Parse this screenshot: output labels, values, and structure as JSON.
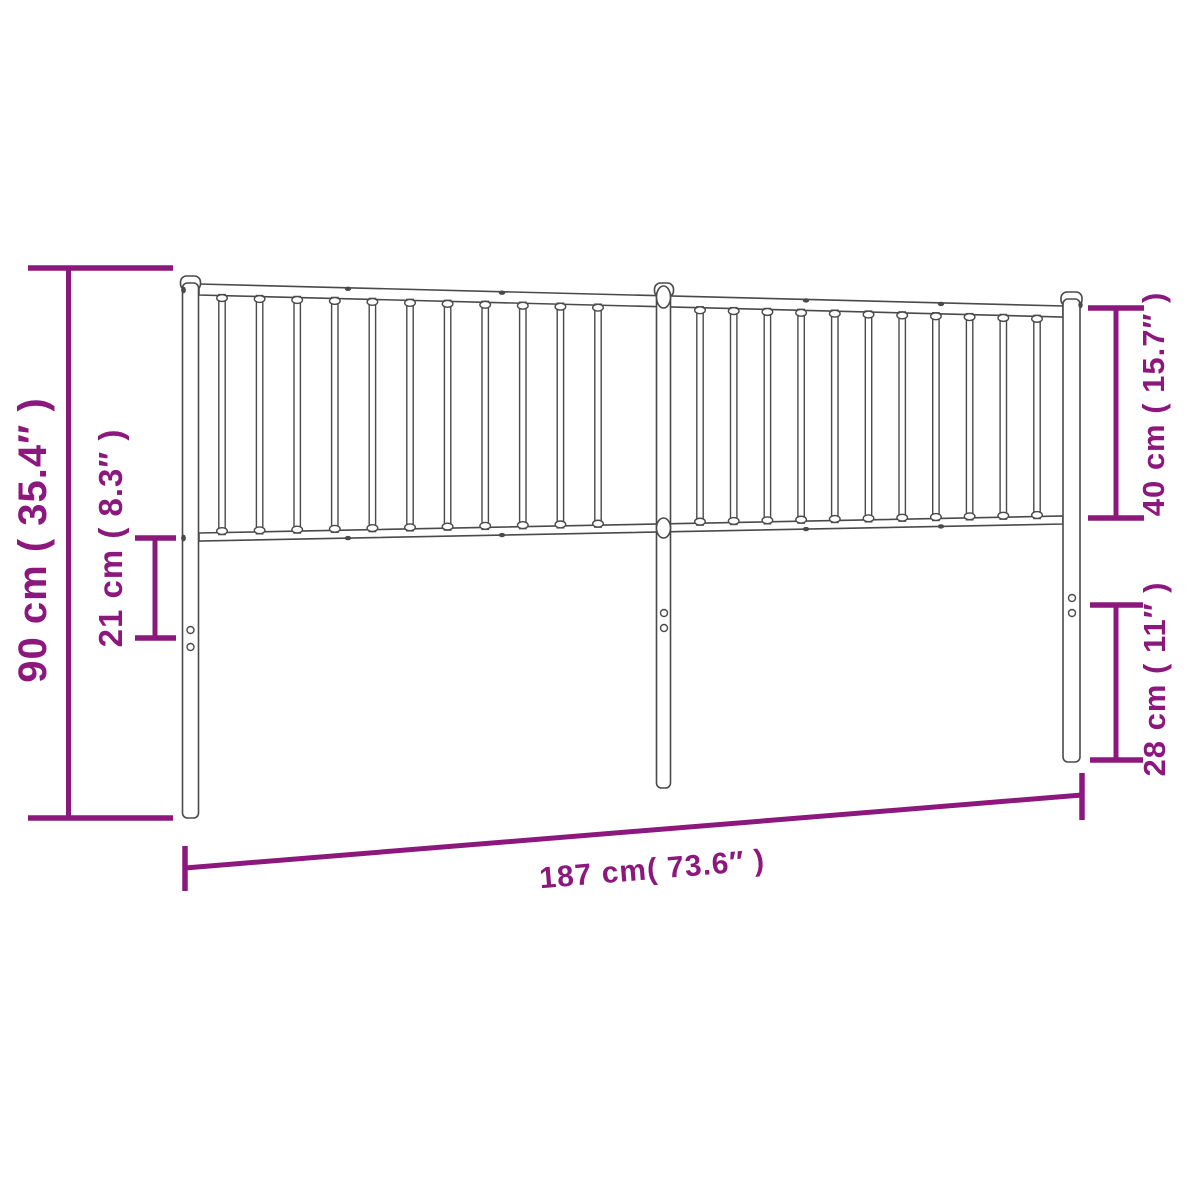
{
  "title": "Metal headboard dimension diagram",
  "colors": {
    "dimension_accent": "#8C187D",
    "drawing_outline": "#4A4A4A",
    "background": "#FFFFFF"
  },
  "dimensions": {
    "overall_height": {
      "label": "90 cm ( 35.4″ )",
      "cm": 90,
      "inches": 35.4
    },
    "lower_rail_to_holes": {
      "label": "21 cm ( 8.3″ )",
      "cm": 21,
      "inches": 8.3
    },
    "panel_height": {
      "label": "40 cm ( 15.7″ )",
      "cm": 40,
      "inches": 15.7
    },
    "leg_height": {
      "label": "28 cm ( 11″ )",
      "cm": 28,
      "inches": 11
    },
    "overall_width": {
      "label": "187 cm( 73.6″ )",
      "cm": 187,
      "inches": 73.6
    }
  },
  "structure": {
    "posts": 3,
    "sections": 2,
    "spindles_per_section": 11,
    "holes_per_post": 2
  }
}
